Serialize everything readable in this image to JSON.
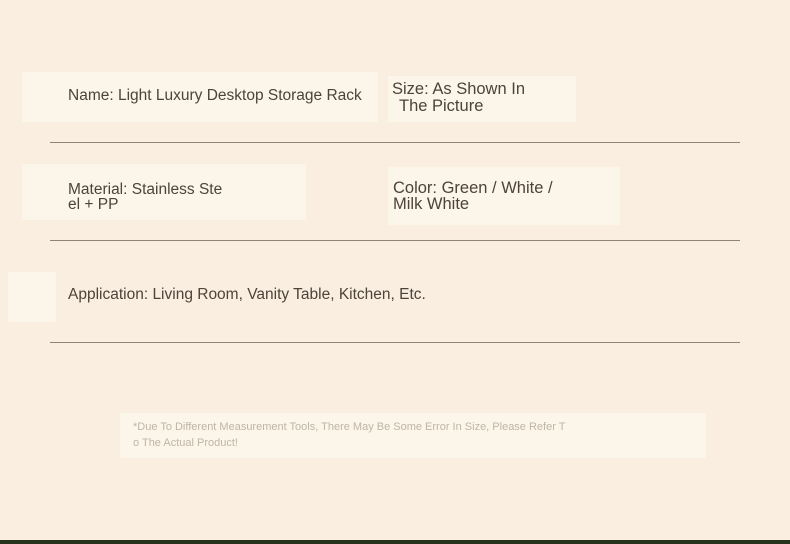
{
  "page": {
    "background_color": "#f9eee0",
    "text_color": "#4d4339",
    "muted_text_color": "#c0b5a5",
    "divider_color": "#8d8379",
    "bottom_bar_color": "#28311c"
  },
  "specs": {
    "name": "Name: Light Luxury Desktop Storage Rack",
    "size_line1": "Size: As Shown In",
    "size_line2": "The Picture",
    "material_line1": "Material: Stainless Ste",
    "material_line2": "el + PP",
    "color_line1": "Color: Green / White /",
    "color_line2": "Milk White",
    "application": "Application: Living Room, Vanity Table, Kitchen, Etc."
  },
  "disclaimer": {
    "line1": "*Due To Different Measurement Tools, There May Be Some Error In Size, Please Refer T",
    "line2": "o The Actual Product!"
  }
}
